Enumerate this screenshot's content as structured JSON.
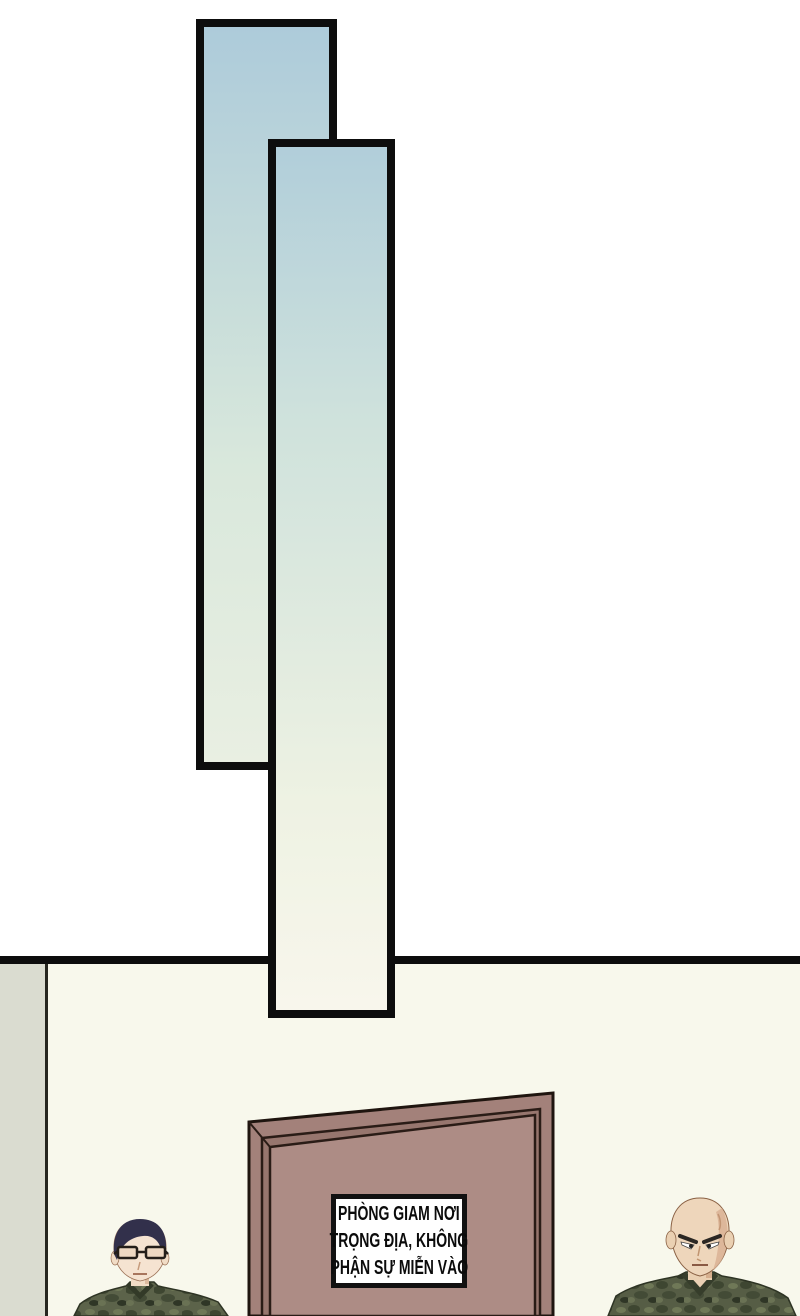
{
  "scene": {
    "type": "comic-panel-page",
    "sign": {
      "lines": [
        "PHÒNG GIAM NƠI",
        "TRỌNG ĐỊA, KHÔNG",
        "PHẬN SỰ MIỄN VÀO"
      ]
    },
    "colors": {
      "page_background": "#ffffff",
      "panel_border": "#0d0d0d",
      "panel_gradient_top": "#aecbd9",
      "panel_gradient_mid": "#d8e8e0",
      "panel_gradient_bottom": "#f8f6ec",
      "floor_line": "#0d0d0d",
      "lower_wall": "#f8f8ec",
      "side_wall": "#dadcd0",
      "door_frame": "#a3817a",
      "door_frame_shadow": "#97766e",
      "door_panel": "#ad8c85",
      "door_outline": "#1f150f",
      "sign_background": "#ffffff",
      "sign_border": "#111111",
      "sign_text": "#0b0b0b",
      "guard_left_hair": "#32304b",
      "guard_left_skin": "#f5e3d1",
      "guard_right_skin": "#eed6bb",
      "guard_right_skin_shadow": "#d9b294",
      "camo_base": "#5c634a",
      "camo_dark": "#3e4631",
      "camo_light": "#6f7857"
    }
  }
}
